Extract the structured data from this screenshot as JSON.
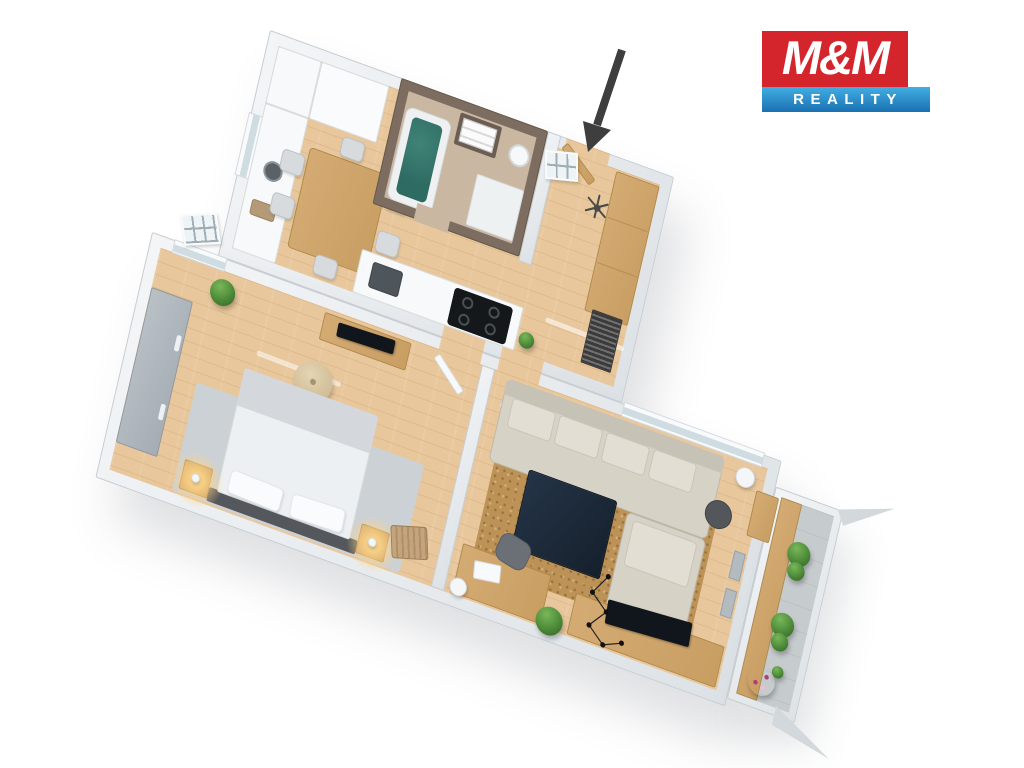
{
  "brand": {
    "logo_top": "M&M",
    "logo_bottom": "REALITY"
  },
  "annotation": {
    "entrance_arrow_color": "#3e3e3e"
  },
  "palette": {
    "logo-red": "#d5252c",
    "logo-blue-top": "#42aee2",
    "logo-blue-bottom": "#1a70b2",
    "wood-floor": "#e8c79c",
    "wood-furniture": "#d4ab73",
    "bath-wall": "#7d6d61",
    "bath-floor": "#c9b7a2",
    "tub-water": "#2e6b62",
    "sofa-beige": "#d6d2c6",
    "rug-tan": "#bc9257",
    "rug-gray": "#ccd1d5",
    "dark-navy": "#15202c",
    "plant-green": "#4c8a38",
    "flower-pink": "#df5d9f",
    "arrow-gray": "#3e3e3e"
  }
}
